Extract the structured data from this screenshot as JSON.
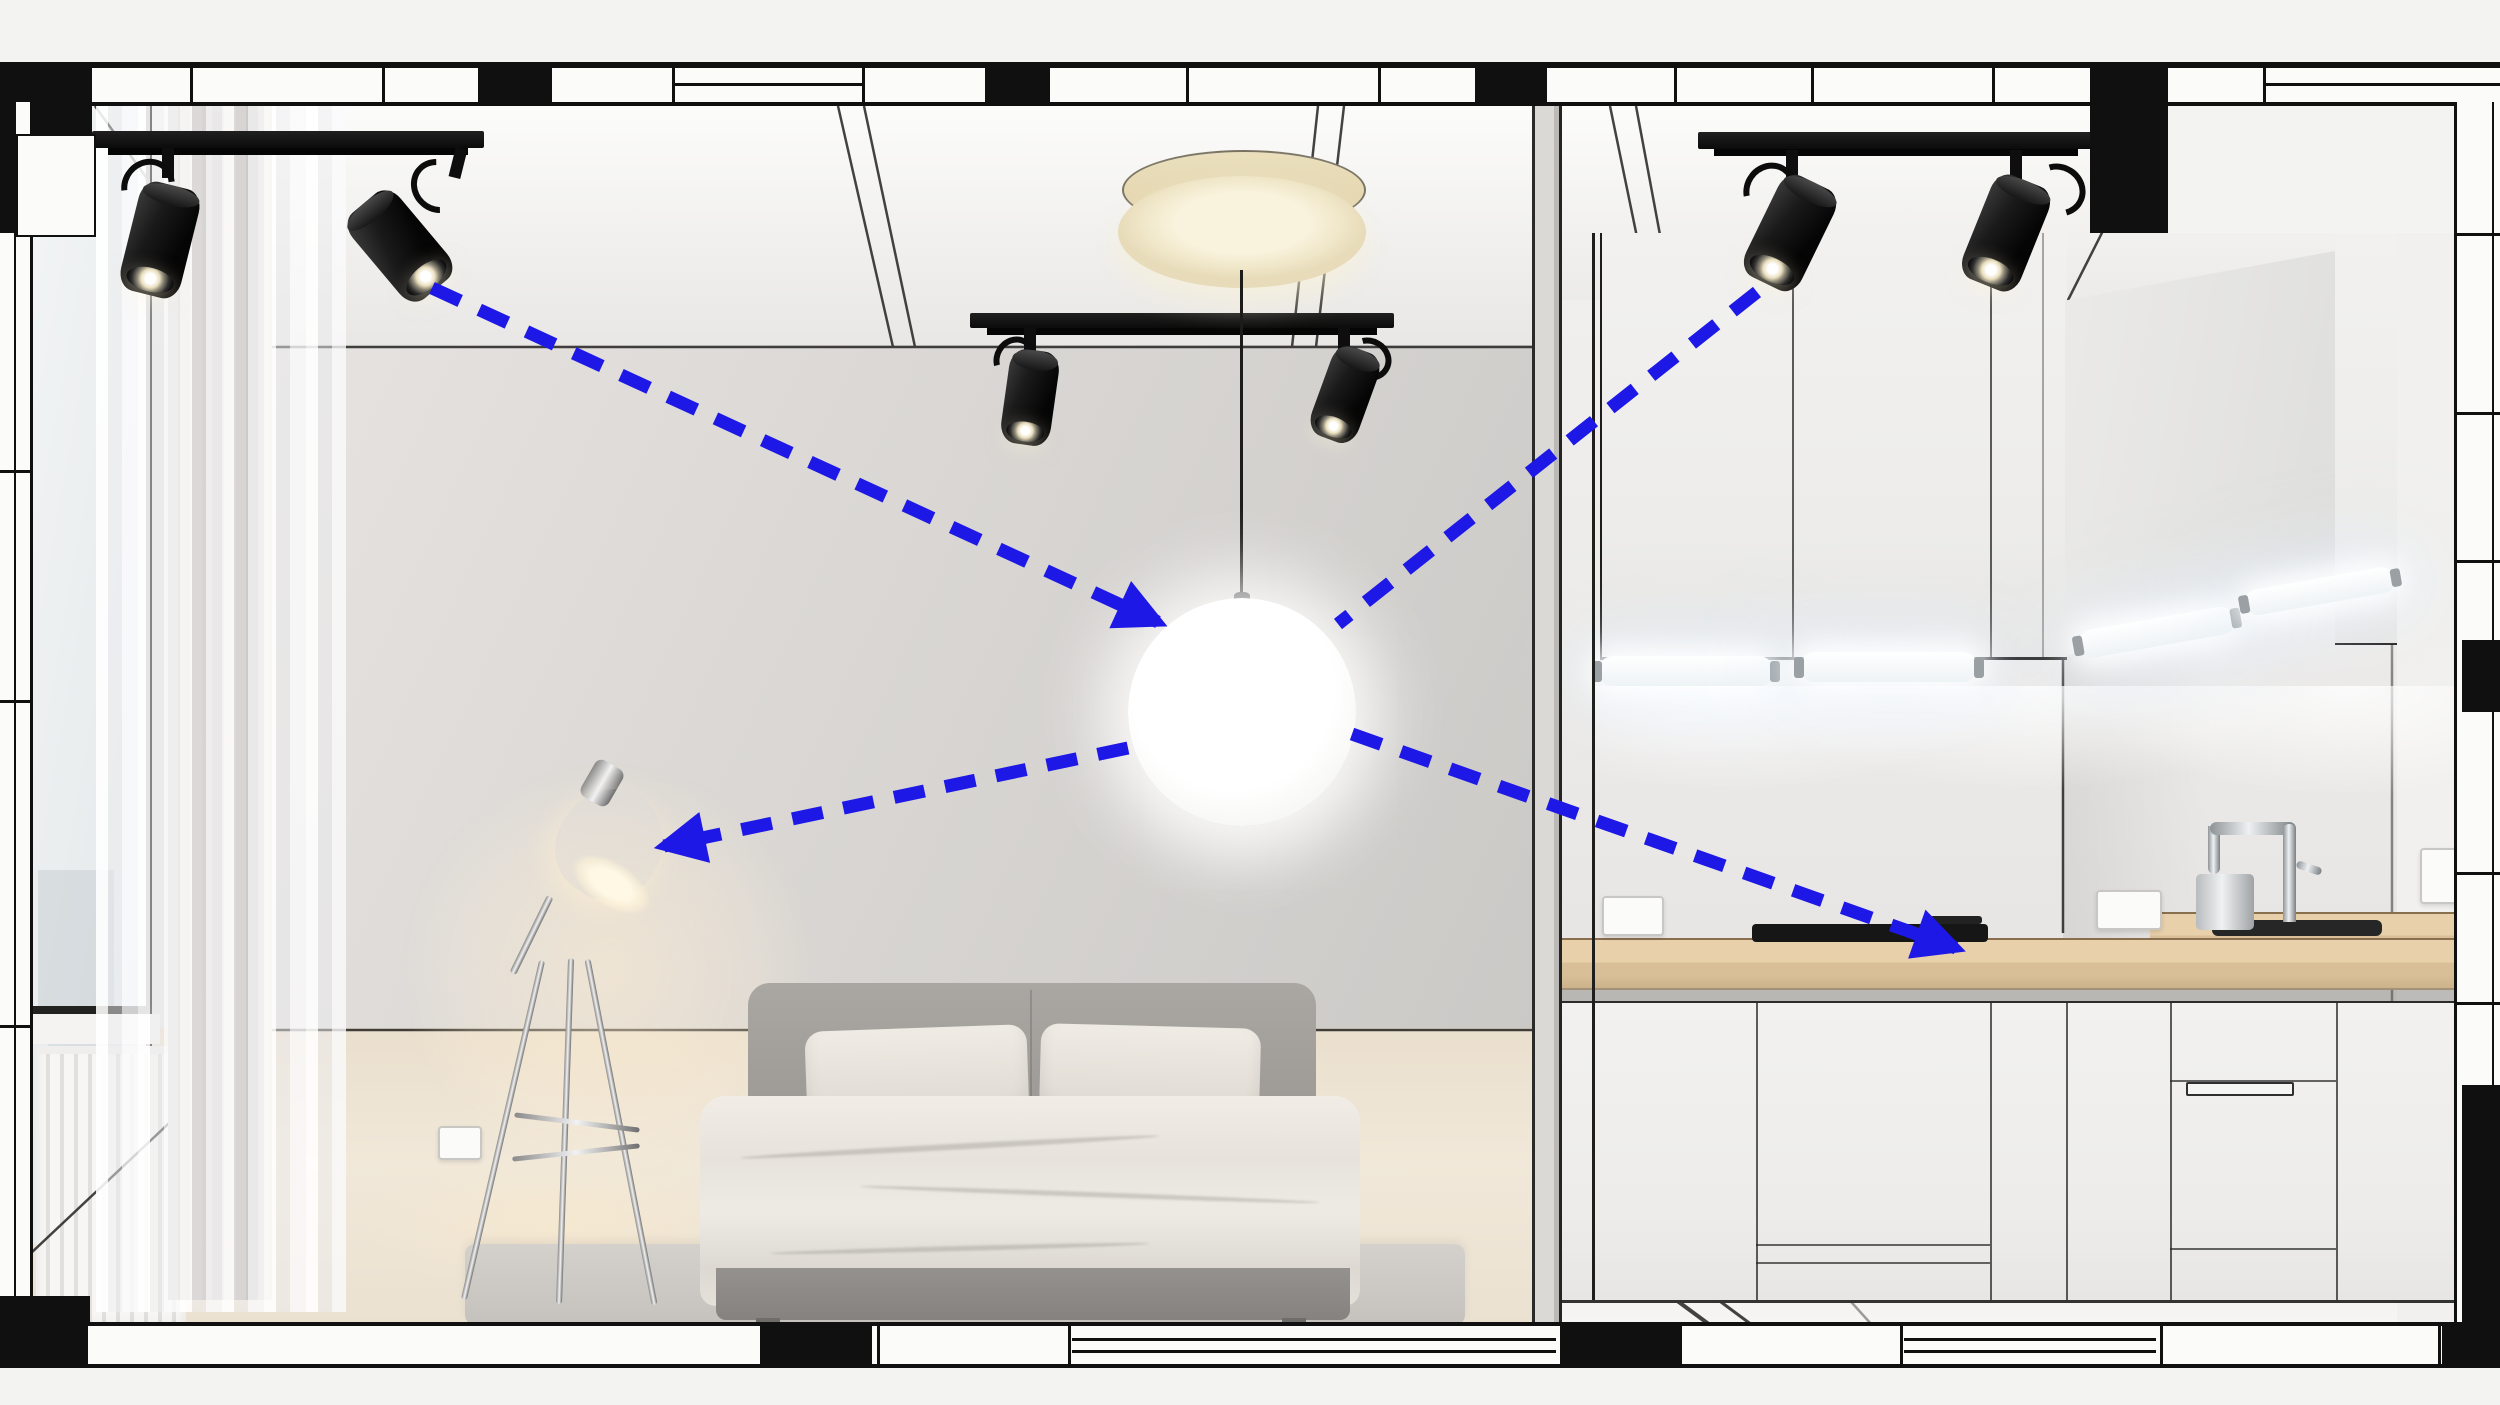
{
  "scene": {
    "description_labels": [],
    "hub_fixture": "globe-pendant",
    "fixtures": [
      {
        "name": "track-light-bedroom",
        "type": "track with 2 black spotlights"
      },
      {
        "name": "track-light-center",
        "type": "track with 2 black spotlights"
      },
      {
        "name": "track-light-kitchen",
        "type": "track with 2 black spotlights"
      },
      {
        "name": "ceiling-canopy",
        "type": "cream drum ceiling mount"
      },
      {
        "name": "globe-pendant",
        "type": "white sphere pendant"
      },
      {
        "name": "floor-lamp",
        "type": "chrome tripod task lamp"
      },
      {
        "name": "under-cabinet-lights",
        "type": "4 linear tubes"
      }
    ]
  },
  "palette": {
    "arrow_blue": "#1d18e6",
    "plan_black": "#101010",
    "canopy_cream": "#efe5c6",
    "wall_gray": "#d8d6d3",
    "wood_floor": "#ecdfcc",
    "counter_wood": "#ddc49e",
    "cabinet_white": "#f1f0ee",
    "warm_glow": "#ffeed2",
    "tube_white": "#ffffff",
    "chrome": "#d7dadc"
  },
  "diagram": {
    "type": "connection-arrows",
    "dash": [
      31,
      21
    ],
    "stroke_width": 13,
    "edges": [
      {
        "from": "track-spotlight-bedroom-right",
        "to": "globe-pendant",
        "arrowhead": true,
        "x1": 432,
        "y1": 288,
        "x2": 1158,
        "y2": 622
      },
      {
        "from": "track-spotlight-kitchen-left",
        "to": "globe-pendant",
        "arrowhead": false,
        "x1": 1757,
        "y1": 292,
        "x2": 1338,
        "y2": 624
      },
      {
        "from": "globe-pendant",
        "to": "floor-lamp",
        "arrowhead": true,
        "x1": 1128,
        "y1": 748,
        "x2": 664,
        "y2": 846
      },
      {
        "from": "globe-pendant",
        "to": "kitchen-cooktop",
        "arrowhead": true,
        "x1": 1352,
        "y1": 734,
        "x2": 1956,
        "y2": 948
      }
    ]
  }
}
